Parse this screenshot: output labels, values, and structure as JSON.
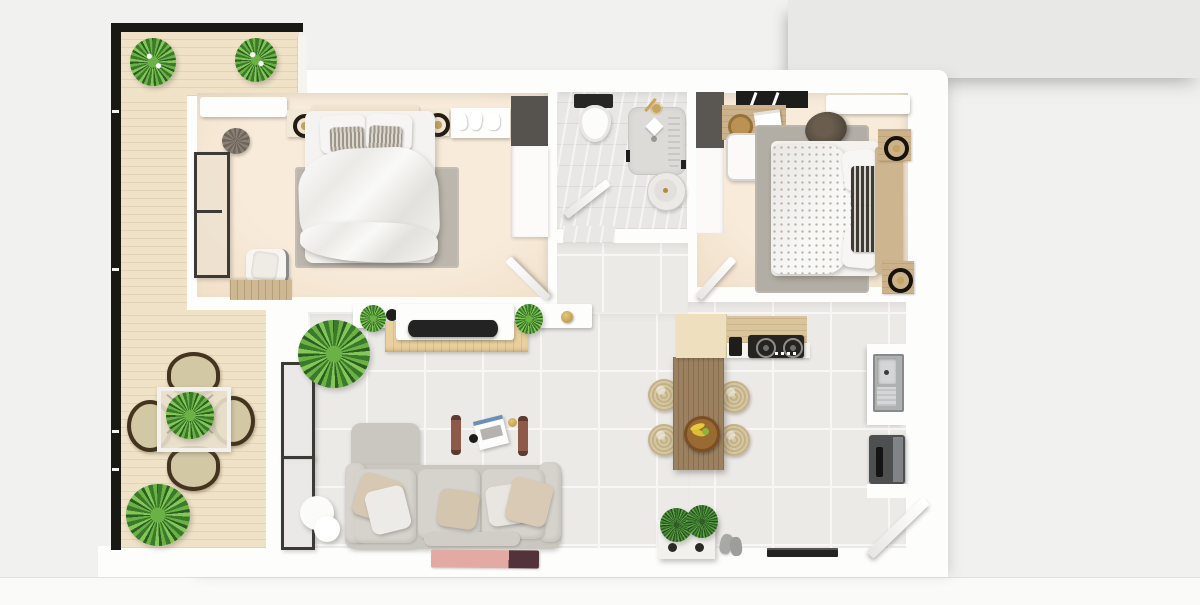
{
  "title": "apartment-floor-plan-3d-top-view",
  "palette": {
    "bg": "#f1f1f0",
    "panel": "#e8e8e7",
    "wall": "#fdfdfc",
    "tile": "#eceae7",
    "grout": "#f8f7f5",
    "cream": "#f8ebda",
    "marble": "#e9e7e5",
    "deck": "#f0e2c6",
    "wood": "#d7c299",
    "woodDark": "#9b815f",
    "rug": "#bcb6ac",
    "rug2": "#b3aea5",
    "sofa": "#cac6c0",
    "sofaLight": "#d6d2cc",
    "beige": "#d6c8b2",
    "green1": "#3b7a2a",
    "green2": "#6ab245",
    "dark": "#222220",
    "steel": "#b9bcbd",
    "gold": "#b3913f",
    "strap": "#8d5a49",
    "pink": "#e3aaa4",
    "pinkDark": "#523339",
    "seat": "#d2c8a4"
  },
  "scene": {
    "view": "top-down 3D rendered apartment floor plan",
    "rooms": [
      {
        "name": "balcony",
        "furniture": [
          "black-railing",
          "wood-decking",
          "flowering-plant",
          "flowering-plant",
          "bistro-table",
          "wicker-chair",
          "wicker-chair",
          "wicker-chair",
          "wicker-chair",
          "leafy-plant"
        ]
      },
      {
        "name": "bedroom-1",
        "furniture": [
          "air-conditioner",
          "round-pouf",
          "window",
          "nightstand-with-lamp",
          "nightstand-with-lamp",
          "double-bed",
          "area-rug",
          "shoe-shelf",
          "two-tone-wardrobe",
          "accent-chair",
          "dresser",
          "door"
        ]
      },
      {
        "name": "bathroom",
        "furniture": [
          "toilet",
          "shower-tray",
          "shower-head",
          "soap-dish",
          "round-basin",
          "towel-hook",
          "door"
        ]
      },
      {
        "name": "hallway",
        "furniture": [
          "floating-sideboard",
          "brass-vase",
          "potted-plant"
        ]
      },
      {
        "name": "bedroom-2",
        "furniture": [
          "dark-wardrobe",
          "wall-shelf",
          "desk",
          "desk-chair",
          "storage-basket",
          "books",
          "air-conditioner",
          "area-rug",
          "fur-pouf",
          "double-bed",
          "wood-headboard",
          "nightstand-with-lamp",
          "nightstand-with-lamp",
          "door"
        ]
      },
      {
        "name": "living-room",
        "furniture": [
          "window",
          "window",
          "floating-shelf",
          "black-planter",
          "tv-stand",
          "television",
          "houseplant",
          "houseplant",
          "brass-pot",
          "swing-straps",
          "laptop",
          "black-mug",
          "sofa-with-chaise",
          "throw-pillow",
          "throw-pillow",
          "throw-pillow",
          "throw-pillow",
          "throw-pillow",
          "floor-lamp",
          "pink-door-mat"
        ]
      },
      {
        "name": "kitchen",
        "furniture": [
          "cabinet",
          "wood-counter",
          "gas-stove",
          "coffee-maker",
          "sink-counter",
          "dark-appliance",
          "entry-door",
          "threshold",
          "dining-table",
          "rattan-stool",
          "rattan-stool",
          "rattan-stool",
          "rattan-stool",
          "fruit-bowl",
          "planter-box",
          "succulent",
          "succulent",
          "slippers"
        ]
      }
    ]
  }
}
